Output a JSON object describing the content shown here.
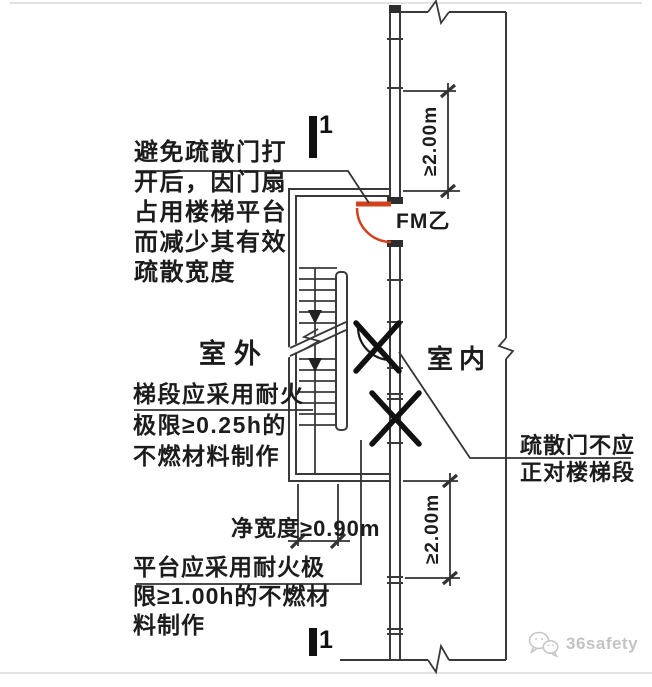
{
  "annotations": {
    "door_swing_note": {
      "lines": [
        "避免疏散门打",
        "开后，因门扇",
        "占用楼梯平台",
        "而减少其有效",
        "疏散宽度"
      ]
    },
    "outdoor_label": "室外",
    "indoor_label": "室内",
    "door_tag": "FM乙",
    "flight_note": {
      "lines": [
        "梯段应采用耐火",
        "极限≥0.25h的",
        "不燃材料制作"
      ]
    },
    "door_position_note": {
      "lines": [
        "疏散门不应",
        "正对楼梯段"
      ]
    },
    "platform_note": {
      "lines": [
        "平台应采用耐火极",
        "限≥1.00h的不燃材",
        "料制作"
      ]
    }
  },
  "dimensions": {
    "top_right": "≥2.00m",
    "bottom_right": "≥2.00m",
    "clear_width": "净宽度≥0.90m"
  },
  "section_marks": {
    "top": "1",
    "bottom": "1"
  },
  "watermark": {
    "brand": "36safety",
    "icon": "wechat-icon"
  },
  "colors": {
    "line": "#3a3a3a",
    "door_red": "#d2401e",
    "text": "#1c1c1c",
    "watermark_gray": "#c3c3c3"
  }
}
